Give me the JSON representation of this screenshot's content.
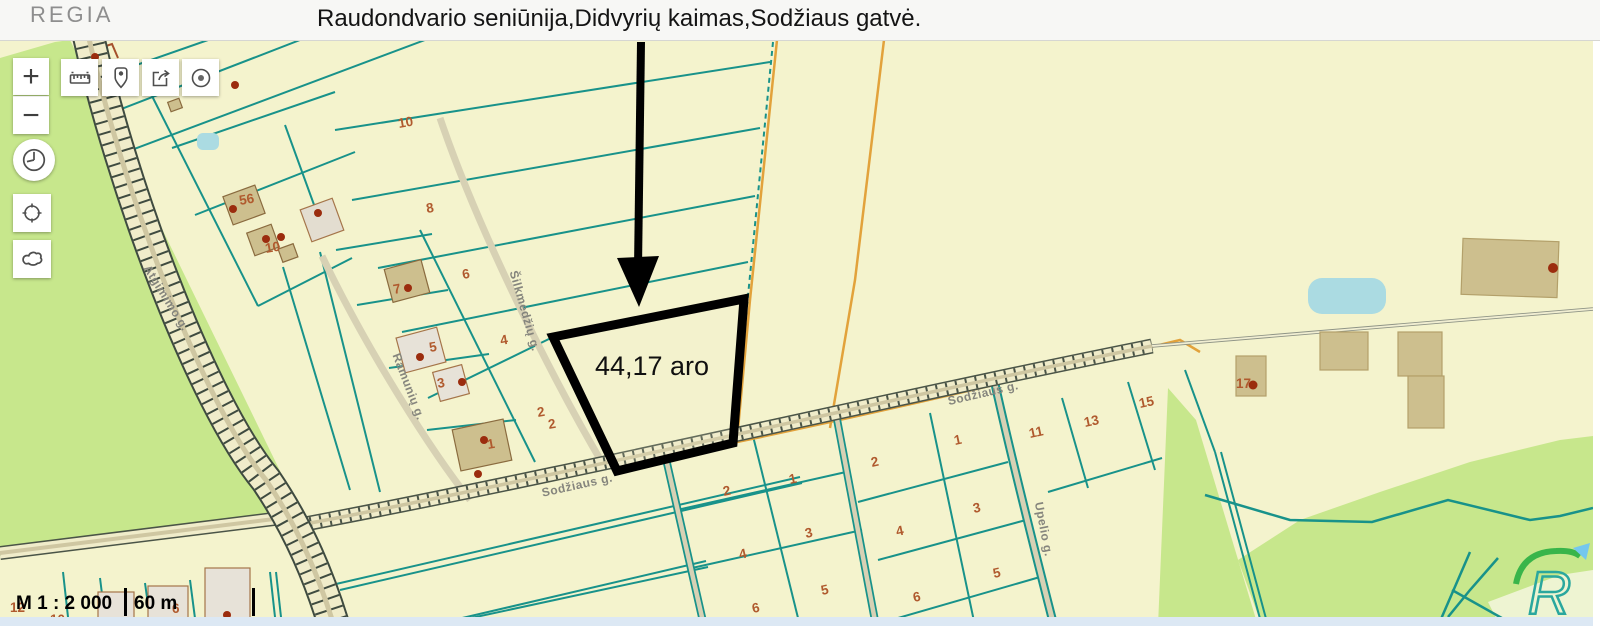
{
  "header": {
    "logo_text": "REGIA",
    "title": "Raudondvario seniūnija,Didvyrių kaimas,Sodžiaus gatvė."
  },
  "toolbar": {
    "zoom_in_glyph": "+",
    "zoom_out_glyph": "−",
    "icons": {
      "measure": "ruler-icon",
      "marker": "pin-icon",
      "share": "share-icon",
      "target": "target-dot-icon",
      "history": "clock-icon",
      "locate": "crosshair-icon",
      "overview": "lithuania-outline-icon"
    }
  },
  "map": {
    "highlight": {
      "area_label": "44,17 aro"
    },
    "streets": [
      "Atgimimo g.",
      "Šilkmedžių g.",
      "Ramunių g.",
      "Sodžiaus g.",
      "Sodžiaus g.",
      "Upelio g."
    ],
    "parcel_numbers": [
      "10",
      "8",
      "6",
      "4",
      "2",
      "56",
      "10",
      "7",
      "5",
      "3",
      "1",
      "2",
      "2",
      "1",
      "4",
      "3",
      "6",
      "5",
      "2",
      "1",
      "4",
      "3",
      "6",
      "5",
      "11",
      "13",
      "15",
      "17",
      "12",
      "10",
      "6"
    ],
    "scale": {
      "ratio": "M 1 : 2 000",
      "distance": "60 m"
    },
    "watermark_letter": "R"
  },
  "colors": {
    "map_background": "#f4f3cd",
    "field_green": "#c7e78c",
    "boundary_teal": "#18928a",
    "boundary_orange": "#e2a23b",
    "road_fill": "#f0ecca",
    "parcel_number_red": "#b05a2e",
    "highlight_black": "#000000",
    "water_blue": "#abdbe2"
  }
}
